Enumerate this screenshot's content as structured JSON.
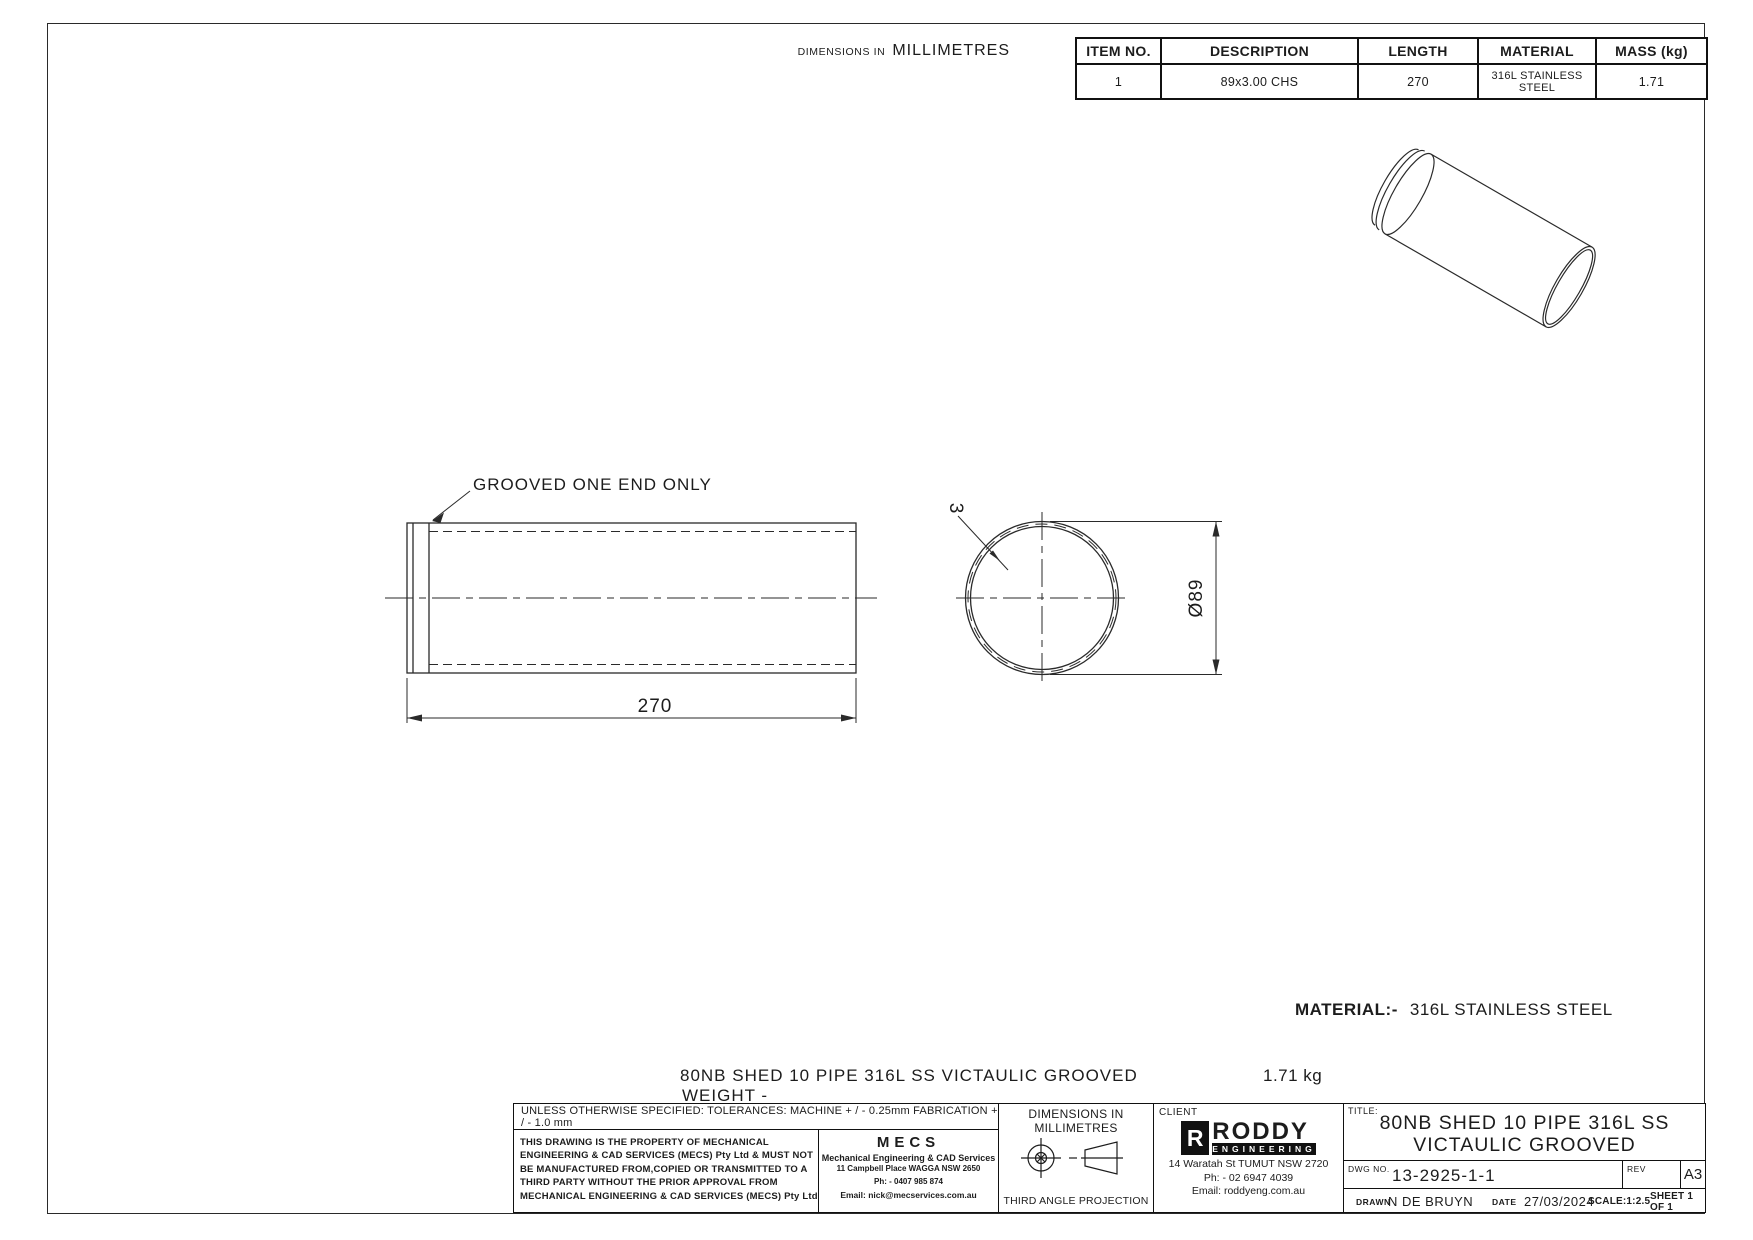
{
  "page": {
    "dims_note_small": "DIMENSIONS IN",
    "dims_note_large": "MILLIMETRES"
  },
  "parts_table": {
    "headers": [
      "ITEM NO.",
      "DESCRIPTION",
      "LENGTH",
      "MATERIAL",
      "MASS (kg)"
    ],
    "rows": [
      {
        "item_no": "1",
        "description": "89x3.00 CHS",
        "length": "270",
        "material": "316L STAINLESS\nSTEEL",
        "mass": "1.71"
      }
    ]
  },
  "views": {
    "side_view": {
      "note": "GROOVED ONE END ONLY",
      "length_dim": "270"
    },
    "end_view": {
      "wall_thickness_dim": "3",
      "diameter_dim": "Ø89"
    }
  },
  "notes": {
    "material_label": "MATERIAL:-",
    "material_value": "316L STAINLESS STEEL",
    "description_line": "80NB SHED 10 PIPE 316L SS VICTAULIC GROOVED",
    "weight_label": "WEIGHT -",
    "weight_value": "1.71 kg"
  },
  "title_block": {
    "tolerances": "UNLESS OTHERWISE SPECIFIED: TOLERANCES: MACHINE + / - 0.25mm  FABRICATION + / - 1.0 mm",
    "property_lines": [
      "THIS DRAWING IS THE PROPERTY OF MECHANICAL",
      "ENGINEERING & CAD SERVICES (MECS) Pty Ltd & MUST NOT",
      "BE MANUFACTURED FROM,COPIED OR TRANSMITTED TO A",
      "THIRD PARTY WITHOUT THE PRIOR APPROVAL FROM",
      "MECHANICAL ENGINEERING & CAD SERVICES (MECS) Pty Ltd"
    ],
    "mecs": {
      "logo": "MECS",
      "line1": "Mechanical Engineering & CAD Services",
      "line2": "11 Campbell Place WAGGA NSW 2650",
      "line3": "Ph: - 0407 985 874",
      "line4": "Email: nick@mecservices.com.au"
    },
    "projection": {
      "dims_line1": "DIMENSIONS IN",
      "dims_line2": "MILLIMETRES",
      "label": "THIRD ANGLE PROJECTION"
    },
    "client": {
      "label": "CLIENT",
      "logo_r": "R",
      "logo_name": "RODDY",
      "logo_sub": "ENGINEERING",
      "address": "14 Waratah St TUMUT NSW 2720",
      "phone": "Ph: - 02 6947 4039",
      "email": "Email: roddyeng.com.au"
    },
    "title_label": "TITLE:",
    "title_line1": "80NB SHED 10 PIPE 316L SS",
    "title_line2": "VICTAULIC GROOVED",
    "dwg_no_label": "DWG NO.",
    "dwg_no": "13-2925-1-1",
    "rev_label": "REV",
    "sheet_size": "A3",
    "drawn_label": "DRAWN",
    "drawn": "N DE BRUYN",
    "date_label": "DATE",
    "date": "27/03/2024",
    "scale": "SCALE:1:2.5",
    "sheet": "SHEET 1 OF 1"
  },
  "colors": {
    "line": "#2a2a2a",
    "ink": "#1c1c1c"
  }
}
